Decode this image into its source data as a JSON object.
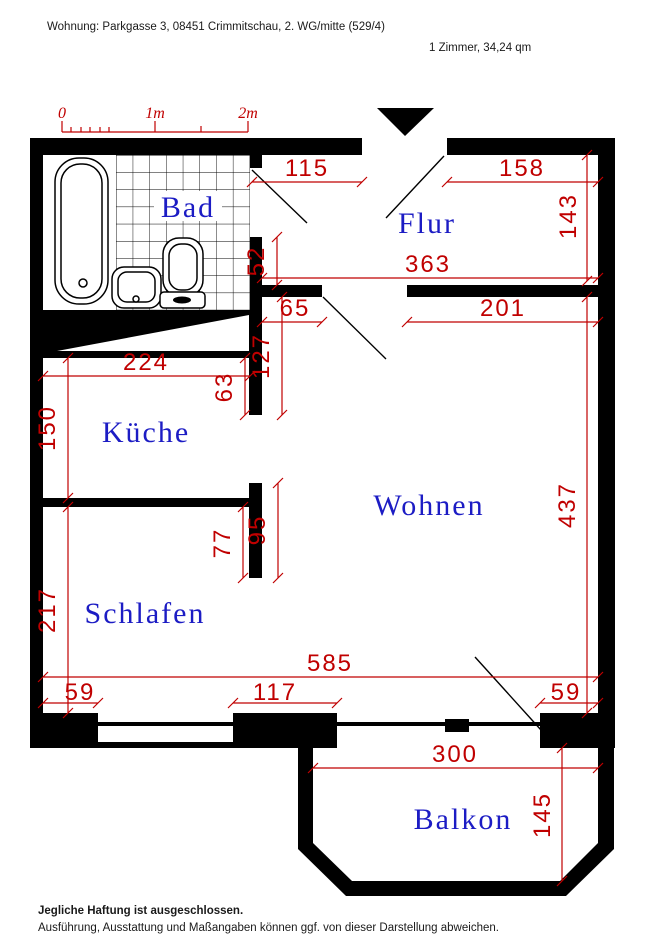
{
  "header": {
    "address_line": "Wohnung: Parkgasse 3, 08451 Crimmitschau, 2. WG/mitte (529/4)",
    "size_line": "1 Zimmer, 34,24 qm"
  },
  "scale_bar": {
    "label_0": "0",
    "label_1m": "1m",
    "label_2m": "2m"
  },
  "rooms": {
    "bad": "Bad",
    "flur": "Flur",
    "kueche": "Küche",
    "wohnen": "Wohnen",
    "schlafen": "Schlafen",
    "balkon": "Balkon"
  },
  "dimensions_cm": {
    "flur_top_left": "115",
    "flur_top_right": "158",
    "flur_height": "143",
    "flur_width": "363",
    "bad_door_pier": "52",
    "wohnen_door_pier_left": "65",
    "wohnen_top_wall_right": "201",
    "kueche_door_offset": "127",
    "kueche_width": "224",
    "kueche_door_pier": "63",
    "kueche_depth": "150",
    "stub_wohnen_side": "95",
    "stub_schlafen_side": "77",
    "schlafen_depth": "217",
    "wohnen_depth": "437",
    "bottom_total": "585",
    "bottom_pier_left": "59",
    "bottom_pier_mid": "117",
    "bottom_pier_right": "59",
    "balkon_width": "300",
    "balkon_depth": "145"
  },
  "footer": {
    "line1": "Jegliche Haftung ist ausgeschlossen.",
    "line2": "Ausführung, Ausstattung und Maßangaben können ggf. von dieser Darstellung abweichen."
  },
  "colors": {
    "dimension_red": "#c00000",
    "room_label_blue": "#1c1cc4",
    "wall_black": "#000000",
    "background": "#ffffff"
  }
}
